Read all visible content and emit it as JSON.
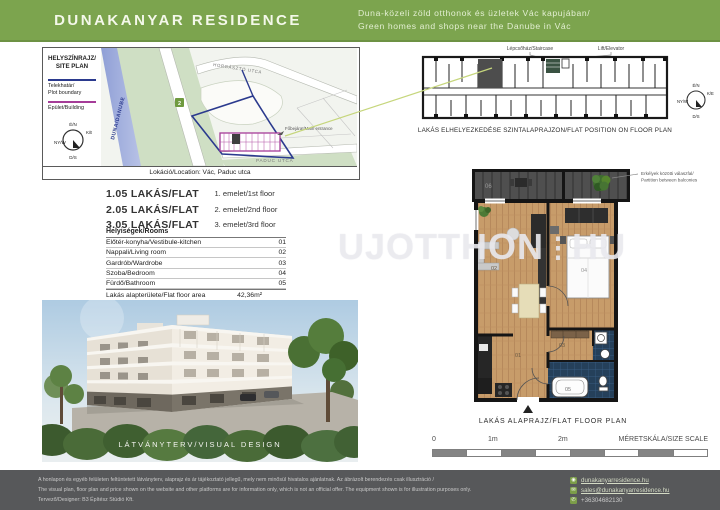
{
  "header": {
    "title": "DUNAKANYAR RESIDENCE",
    "subtitle_hu": "Duna-közeli zöld otthonok és üzletek Vác kapujában/",
    "subtitle_en": "Green homes and shops near the Danube in Vác"
  },
  "site_plan": {
    "title_line1": "HELYSZÍNRAJZ/",
    "title_line2": "SITE PLAN",
    "plot_boundary_line1": "Telekhatár/",
    "plot_boundary_line2": "Plot boundary",
    "building_label": "Épület/Building",
    "river_label": "DUNA/DANUBE",
    "street_top": "HORGÁSZTÓ UTCA",
    "street_bottom": "PADUC UTCA",
    "entrance_label": "Főbejárat/Main entrance",
    "badge": "2",
    "caption": "Lokáció/Location: Vác, Paduc utca"
  },
  "compass": {
    "n": "É/N",
    "e": "K/E",
    "w": "NY/W",
    "s": "D/S"
  },
  "flats": [
    {
      "name": "1.05 LAKÁS/FLAT",
      "floor": "1. emelet/1st floor"
    },
    {
      "name": "2.05 LAKÁS/FLAT",
      "floor": "2. emelet/2nd floor"
    },
    {
      "name": "3.05 LAKÁS/FLAT",
      "floor": "3. emelet/3rd floor"
    }
  ],
  "rooms": {
    "header": "Helyiségek/Rooms",
    "items": [
      {
        "label": "Előtér-konyha/Vestibule-kitchen",
        "area": "",
        "code": "01"
      },
      {
        "label": "Nappali/Living room",
        "area": "",
        "code": "02"
      },
      {
        "label": "Gardrób/Wardrobe",
        "area": "",
        "code": "03"
      },
      {
        "label": "Szoba/Bedroom",
        "area": "",
        "code": "04"
      },
      {
        "label": "Fürdő/Bathroom",
        "area": "",
        "code": "05"
      },
      {
        "label": "Lakás alapterülete/Flat floor area",
        "area": "42,36m²",
        "code": ""
      },
      {
        "label": "Erkély/Balcony",
        "area": "8,90m²",
        "code": "06"
      }
    ]
  },
  "visual": {
    "caption": "LÁTVÁNYTERV/VISUAL DESIGN"
  },
  "position_plan": {
    "staircase_label": "Lépcsőház/Staircase",
    "elevator_label": "Lift/Elevator",
    "caption": "LAKÁS ELHELYEZKEDÉSE SZINTALAPRAJZON/FLAT POSITION ON FLOOR PLAN"
  },
  "floor_plan": {
    "caption": "LAKÁS ALAPRAJZ/FLAT FLOOR PLAN",
    "partition_note_line1": "Erkélyek közötti válaszfal/",
    "partition_note_line2": "Partition between balconies",
    "labels": {
      "r01": "01",
      "r02": "02",
      "r03": "03",
      "r04": "04",
      "r05": "05",
      "r06": "06"
    }
  },
  "scale_bar": {
    "zero": "0",
    "one": "1m",
    "two": "2m",
    "label": "MÉRETSKÁLA/SIZE SCALE"
  },
  "watermark": {
    "left": "UJOTTHON",
    "separator": "⋮",
    "right": "HU"
  },
  "footer": {
    "disclaimer_hu": "A honlapon és egyéb felületen feltüntetett látványterv, alaprajz és ár tájékoztató jellegű, mely nem minősül hivatalos ajánlatnak. Az ábrázolt berendezés csak illusztráció /",
    "disclaimer_en": "The visual plan, floor plan and price shown on the website and other platforms are for information only, which is not an official offer. The equipment shown is for illustration purposes only.",
    "designer": "Tervező/Designer: B3 Építész Stúdió Kft.",
    "website": "dunakanyarresidence.hu",
    "email": "sales@dunakanyarresidence.hu",
    "phone": "+36304682130"
  },
  "colors": {
    "header_green": "#7CA44E",
    "footer_gray": "#57585A",
    "plot_boundary_blue": "#2B3A8E",
    "building_magenta": "#A53C98",
    "link_green": "#7C9D49",
    "wood_floor": "#C79C6A",
    "bath_tile": "#25405A"
  }
}
